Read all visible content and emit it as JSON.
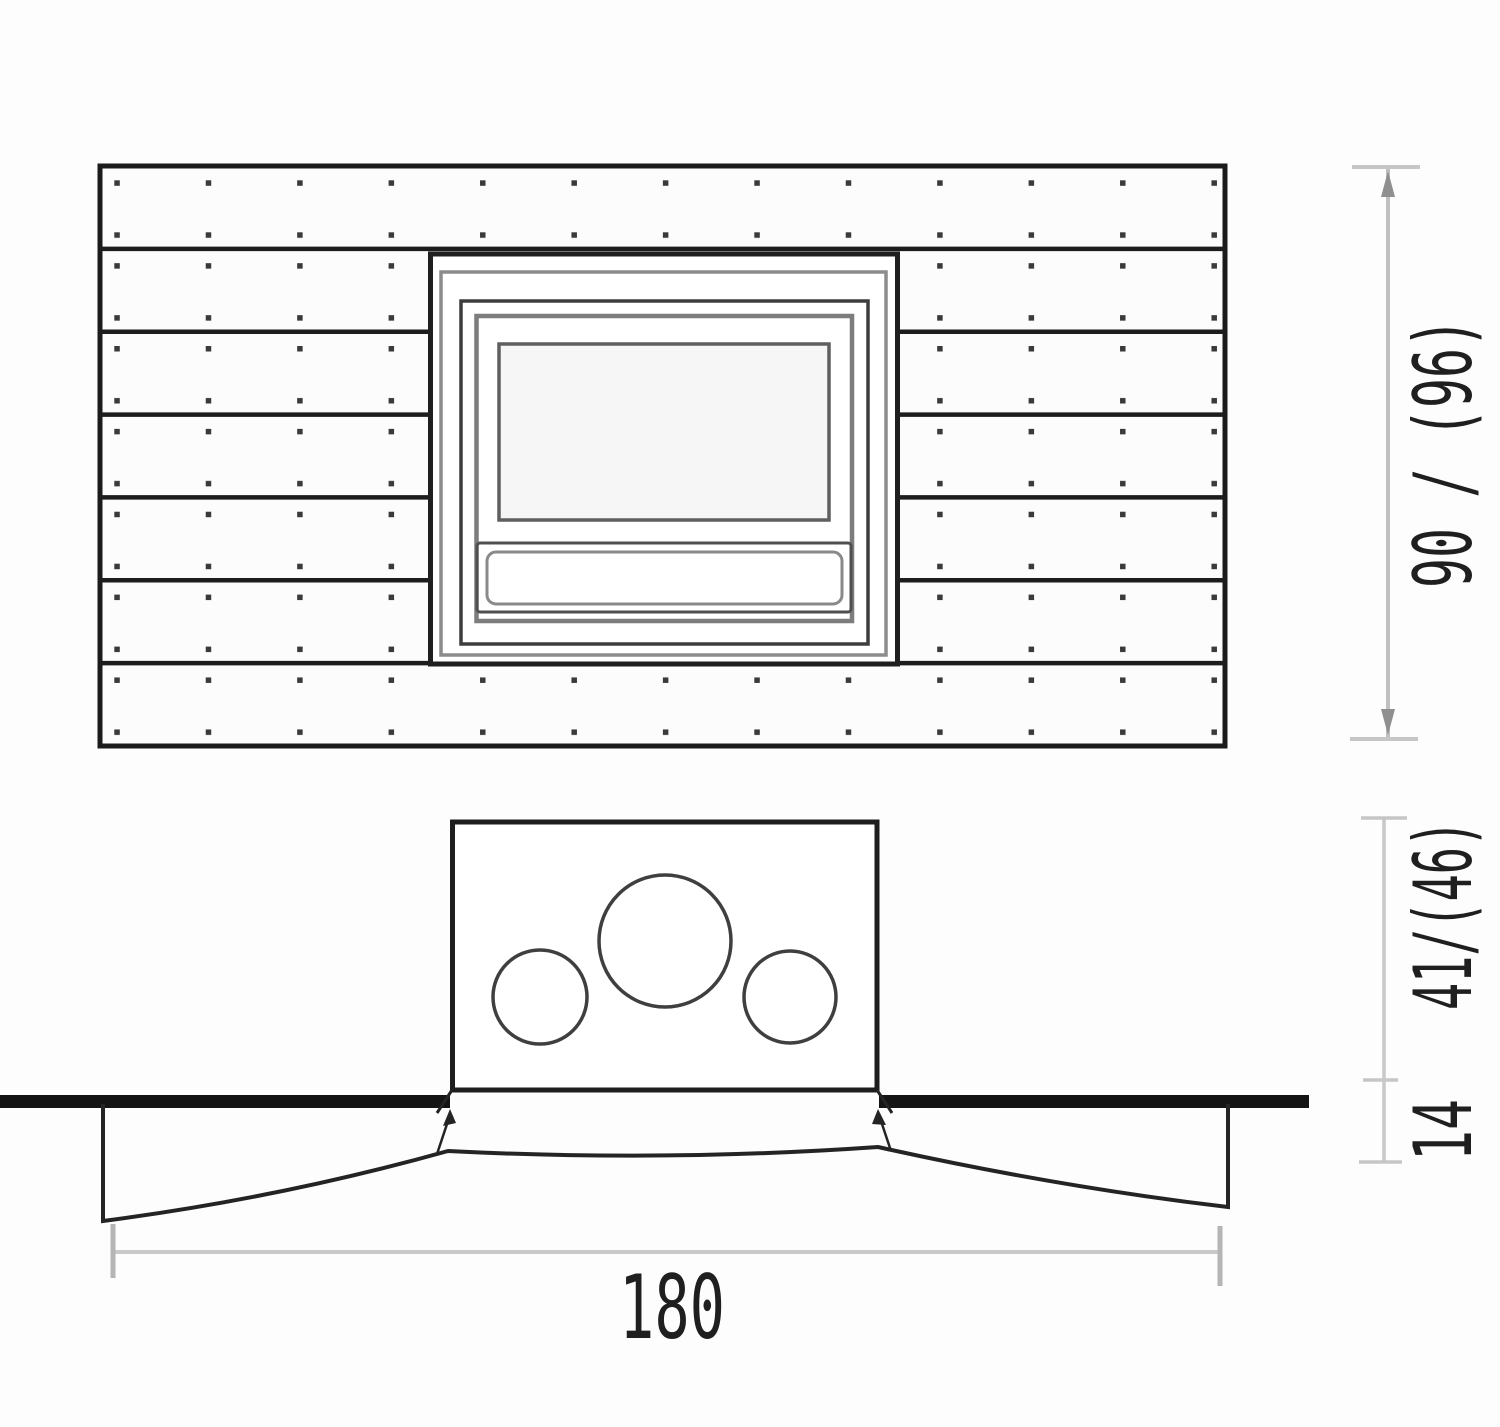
{
  "drawing": {
    "type": "installation-dimension-diagram",
    "views": {
      "front_view": {
        "plank_rows": 7,
        "screw_columns": 13,
        "split_rows": 5
      },
      "plan_view": {
        "circle_openings": 3
      }
    },
    "colors": {
      "background": "#fdfdfd",
      "line_dark": "#1d1d1d",
      "line_gray": "#8a8a8a",
      "wall_line": "#141414",
      "dim_line": "#c0c0c0",
      "dim_arrow": "#8f8f8f",
      "text": "#1f1f1f"
    }
  },
  "dimensions": {
    "height_label": "90 / (96)",
    "depth_upper_label": "41/(46)",
    "depth_lower_label": "14",
    "width_label": "180"
  }
}
